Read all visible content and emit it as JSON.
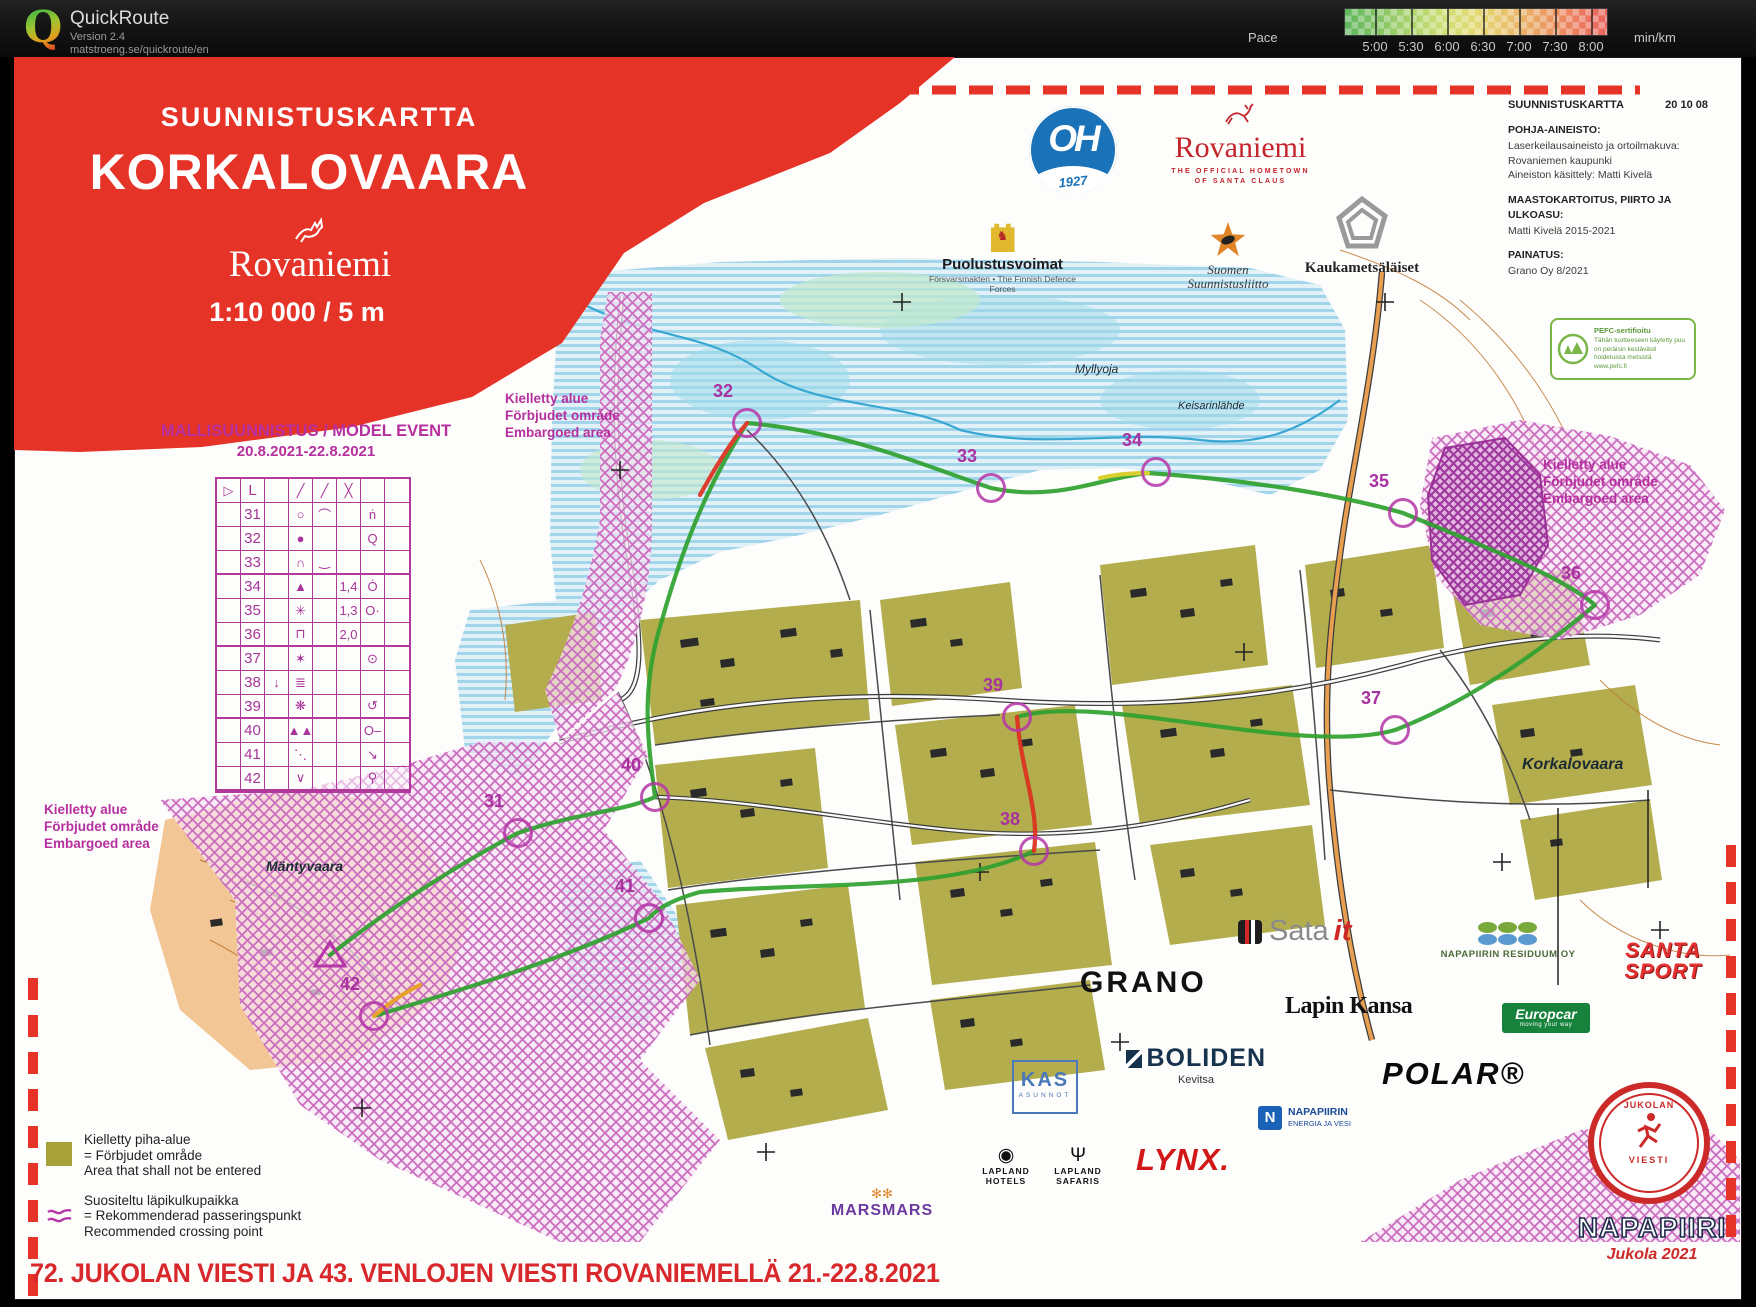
{
  "titlebar": {
    "app_name": "QuickRoute",
    "version": "Version 2.4",
    "url": "matstroeng.se/quickroute/en",
    "logo_letter": "Q",
    "pace": {
      "label": "Pace",
      "unit": "min/km",
      "ticks": [
        "5:00",
        "5:30",
        "6:00",
        "6:30",
        "7:00",
        "7:30",
        "8:00"
      ]
    }
  },
  "header": {
    "kicker": "SUUNNISTUSKARTTA",
    "title": "KORKALOVAARA",
    "city": "Rovaniemi",
    "scale_text": "1:10 000  /  5 m"
  },
  "model_event": {
    "title": "MALLISUUNNISTUS / MODEL EVENT",
    "dates": "20.8.2021-22.8.2021"
  },
  "control_table": {
    "header": [
      "▷",
      "L",
      "",
      "╱",
      "╱",
      "╳",
      "",
      ""
    ],
    "rows": [
      [
        "",
        "31",
        "",
        "○",
        "⌒",
        "",
        "ṅ",
        ""
      ],
      [
        "",
        "32",
        "",
        "●",
        "",
        "",
        "Q",
        ""
      ],
      [
        "",
        "33",
        "",
        "∩",
        "‿",
        "",
        "",
        ""
      ],
      [
        "",
        "34",
        "",
        "▲",
        "",
        "1,4",
        "Ȯ",
        ""
      ],
      [
        "",
        "35",
        "",
        "✳",
        "",
        "1,3",
        "O·",
        ""
      ],
      [
        "",
        "36",
        "",
        "⊓",
        "",
        "2,0",
        "",
        ""
      ],
      [
        "",
        "37",
        "",
        "✶",
        "",
        "",
        "⊙",
        ""
      ],
      [
        "",
        "38",
        "↓",
        "≣",
        "",
        "",
        "",
        ""
      ],
      [
        "",
        "39",
        "",
        "❋",
        "",
        "",
        "↺",
        ""
      ],
      [
        "",
        "40",
        "",
        "▲▲",
        "",
        "",
        "O–",
        ""
      ],
      [
        "",
        "41",
        "",
        "⋱",
        "",
        "",
        "↘",
        ""
      ],
      [
        "",
        "42",
        "",
        "∨",
        "",
        "",
        "⚲",
        ""
      ]
    ]
  },
  "embargo": {
    "lines": [
      "Kielletty alue",
      "Förbjudet område",
      "Embargoed area"
    ],
    "positions": [
      {
        "x": 505,
        "y": 390
      },
      {
        "x": 1543,
        "y": 456
      },
      {
        "x": 44,
        "y": 801
      }
    ]
  },
  "controls": [
    {
      "n": "31",
      "x": 518,
      "y": 833
    },
    {
      "n": "32",
      "x": 747,
      "y": 423
    },
    {
      "n": "33",
      "x": 991,
      "y": 488
    },
    {
      "n": "34",
      "x": 1156,
      "y": 472
    },
    {
      "n": "35",
      "x": 1403,
      "y": 513
    },
    {
      "n": "36",
      "x": 1595,
      "y": 605
    },
    {
      "n": "37",
      "x": 1395,
      "y": 730
    },
    {
      "n": "38",
      "x": 1034,
      "y": 851
    },
    {
      "n": "39",
      "x": 1017,
      "y": 717
    },
    {
      "n": "40",
      "x": 655,
      "y": 797
    },
    {
      "n": "41",
      "x": 649,
      "y": 918
    },
    {
      "n": "42",
      "x": 374,
      "y": 1016
    }
  ],
  "place_labels": [
    {
      "text": "Myllyoja",
      "x": 1075,
      "y": 362,
      "fs": 12,
      "bold": false
    },
    {
      "text": "Keisarinlähde",
      "x": 1178,
      "y": 400,
      "fs": 11,
      "bold": false
    },
    {
      "text": "Korkalovaara",
      "x": 1522,
      "y": 756,
      "fs": 16,
      "bold": true
    },
    {
      "text": "Mäntyvaara",
      "x": 266,
      "y": 858,
      "fs": 14,
      "bold": true
    }
  ],
  "legend": {
    "item1_lines": [
      "Kielletty piha-alue",
      "=  Förbjudet område",
      "Area that shall not be entered"
    ],
    "item2_lines": [
      "Suositeltu läpikulkupaikka",
      "=  Rekommenderad passeringspunkt",
      "Recommended crossing point"
    ]
  },
  "credits": {
    "title": "SUUNNISTUSKARTTA",
    "code": "20 10 08",
    "sections": [
      {
        "heading": "POHJA-AINEISTO:",
        "lines": [
          "Laserkeilausaineisto ja ortoilmakuva:",
          "Rovaniemen kaupunki",
          "Aineiston käsittely: Matti Kivelä"
        ]
      },
      {
        "heading": "MAASTOKARTOITUS, PIIRTO JA ULKOASU:",
        "lines": [
          "Matti Kivelä 2015-2021"
        ]
      },
      {
        "heading": "PAINATUS:",
        "lines": [
          "Grano Oy  8/2021"
        ]
      }
    ]
  },
  "pefc": {
    "title": "PEFC-sertifioitu",
    "lines": [
      "Tähän tuotteeseen käytetty puu",
      "on peräisin kestävästi",
      "hoidetuista metsistä",
      "www.pefc.fi"
    ]
  },
  "sponsors": {
    "oh": {
      "letters": "OH",
      "year": "1927"
    },
    "rovaniemi": {
      "name": "Rovaniemi",
      "tag1": "THE OFFICIAL HOMETOWN",
      "tag2": "OF SANTA CLAUS"
    },
    "defence": {
      "name": "Puolustusvoimat",
      "sub": "Försvarsmakten • The Finnish Defence Forces"
    },
    "federation": {
      "line1": "Suomen",
      "line2": "Suunnistusliitto"
    },
    "kauka": {
      "name": "Kaukametsäläiset"
    },
    "sata": {
      "word1": "Sata",
      "word2": "it"
    },
    "residuum": {
      "name": "NAPAPIIRIN RESIDUUM OY"
    },
    "santasport": {
      "line1": "SANTA",
      "line2": "SPORT"
    },
    "grano": {
      "name": "GRANO"
    },
    "lapinkansa": {
      "name": "Lapin Kansa"
    },
    "europcar": {
      "name": "Europcar",
      "tag": "moving your way"
    },
    "kas": {
      "name": "KAS",
      "sub": "ASUNNOT"
    },
    "boliden": {
      "name": "BOLIDEN",
      "sub": "Kevitsa"
    },
    "polar": {
      "name": "POLAR®"
    },
    "neve": {
      "line1": "NAPAPIIRIN",
      "line2": "ENERGIA JA VESI"
    },
    "lynx": {
      "name": "LYNX."
    },
    "marsmars": {
      "icon": "✻✻",
      "name": "MARSMARS"
    },
    "lhotels": {
      "icon": "◉",
      "line1": "LAPLAND",
      "line2": "HOTELS"
    },
    "lsafaris": {
      "icon": "Ψ",
      "line1": "LAPLAND",
      "line2": "SAFARIS"
    }
  },
  "emblem": {
    "arc_top": "JUKOLAN",
    "arc_bottom": "VIESTI",
    "name": "NAPAPIIRI",
    "sub": "Jukola 2021"
  },
  "footer": {
    "text": "72. JUKOLAN VIESTI JA 43. VENLOJEN VIESTI  ROVANIEMELLÄ 21.-22.8.2021"
  }
}
